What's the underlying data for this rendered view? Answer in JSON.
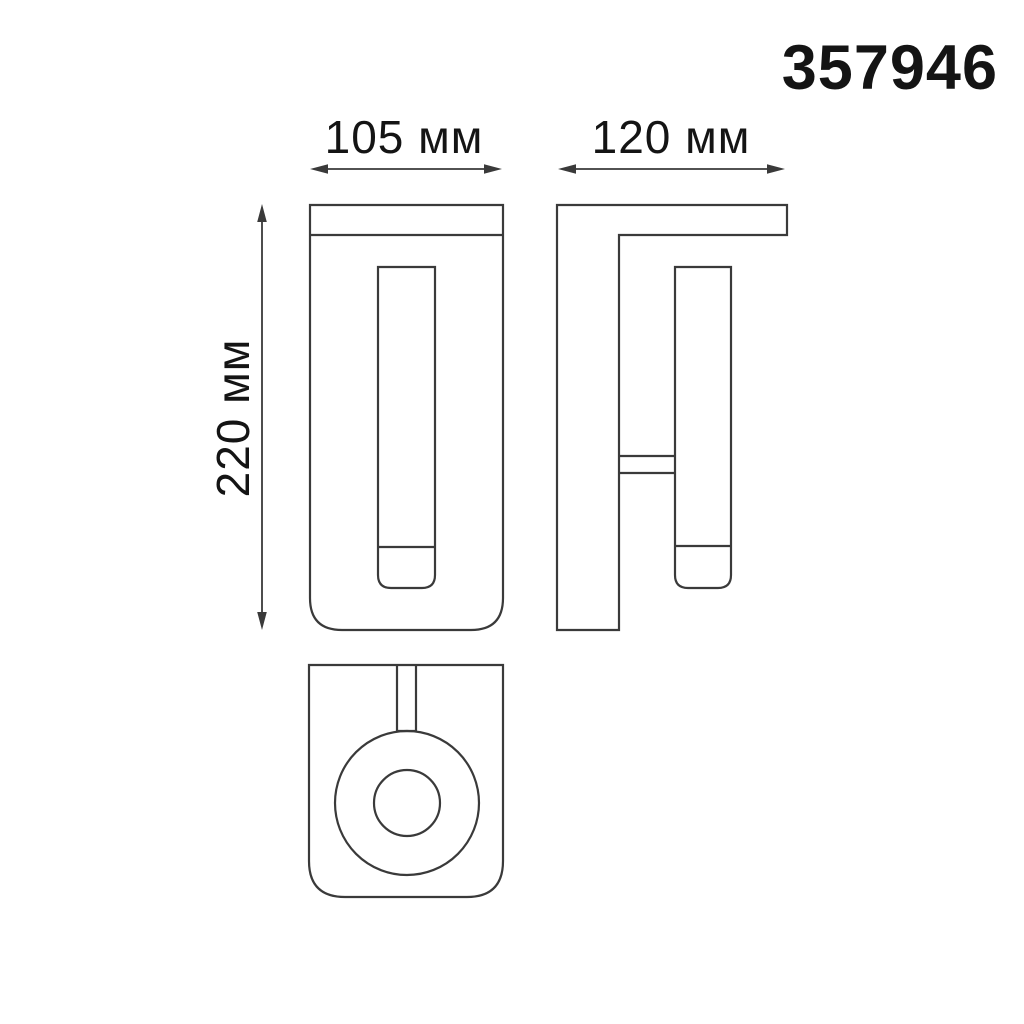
{
  "product_code": "357946",
  "dimensions": {
    "front_width": "105 мм",
    "side_depth": "120 мм",
    "height": "220 мм"
  },
  "colors": {
    "background": "#ffffff",
    "line": "#3a3a3a",
    "text": "#141414"
  }
}
